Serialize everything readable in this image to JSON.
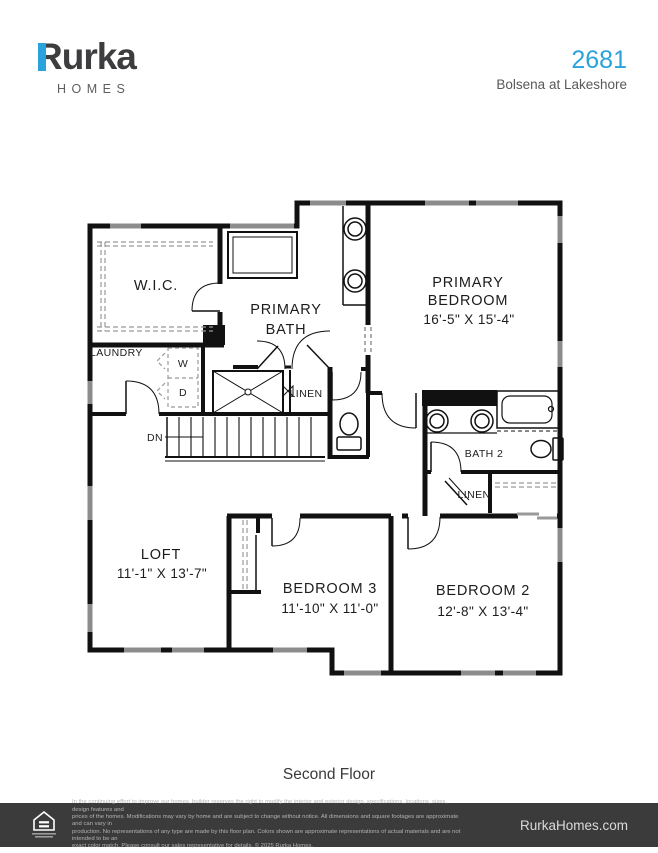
{
  "header": {
    "brand": "Rurka",
    "brand_sub": "HOMES",
    "plan_number": "2681",
    "community": "Bolsena at Lakeshore"
  },
  "colors": {
    "brand_blue": "#2aa2dc",
    "footer_bg": "#3b3b3b"
  },
  "floorplan": {
    "rooms": {
      "wic": "W.I.C.",
      "primary_bath_line1": "PRIMARY",
      "primary_bath_line2": "BATH",
      "primary_bedroom_line1": "PRIMARY",
      "primary_bedroom_line2": "BEDROOM",
      "primary_bedroom_dims": "16'-5\" X 15'-4\"",
      "laundry": "LAUNDRY",
      "washer": "W",
      "dryer": "D",
      "linen_upper": "LINEN",
      "stairs_dn": "DN",
      "bath2": "BATH 2",
      "linen_lower": "LINEN",
      "loft": "LOFT",
      "loft_dims": "11'-1\" X 13'-7\"",
      "bedroom3": "BEDROOM 3",
      "bedroom3_dims": "11'-10\" X 11'-0\"",
      "bedroom2": "BEDROOM 2",
      "bedroom2_dims": "12'-8\" X 13'-4\""
    },
    "caption": "Second Floor"
  },
  "footer": {
    "disclaimer": [
      "In the continuing effort to improve our homes, builder reserves the right to modify the interior and exterior design, specifications, locations, sizes, design features and",
      "prices of the homes. Modifications may vary by home and are subject to change without notice. All dimensions and square footages are approximate and can vary in",
      "production. No representations of any type are made by this floor plan. Colors shown are approximate representations of actual materials and are not intended to be an",
      "exact color match. Please consult our sales representative for details. © 2025 Rurka Homes."
    ],
    "website": "RurkaHomes.com"
  }
}
